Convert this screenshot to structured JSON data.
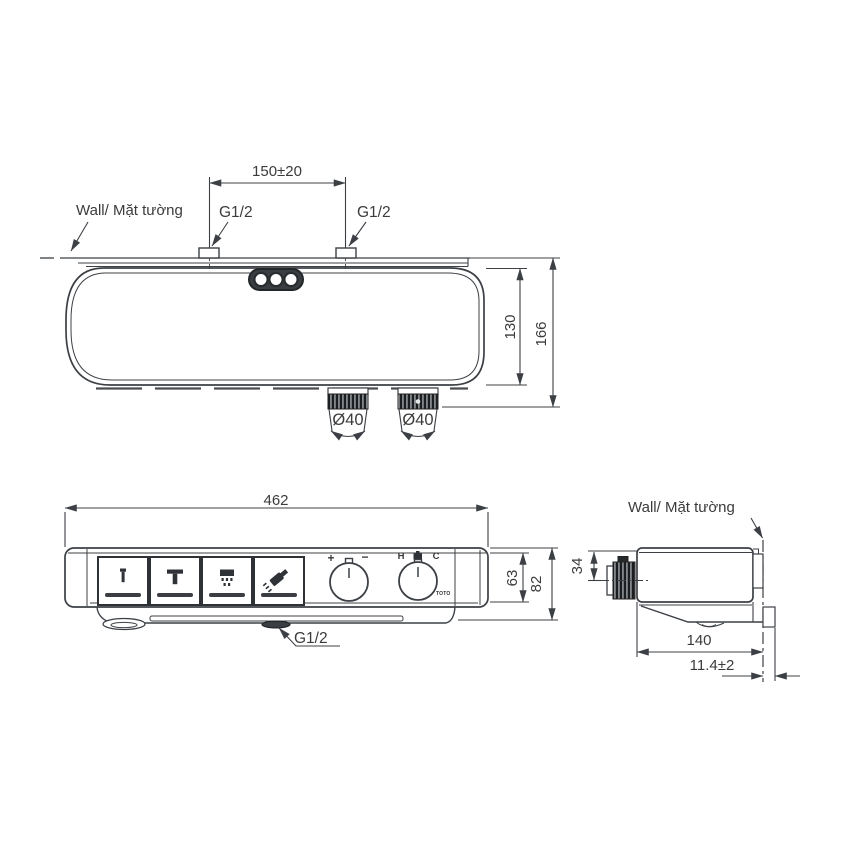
{
  "colors": {
    "line": "#3c4045",
    "text": "#3b3b3b",
    "dark_fill": "#33373b",
    "background": "#ffffff"
  },
  "top_view": {
    "wall_label": "Wall/ Mặt tường",
    "inlet_spacing_dim": "150±20",
    "left_inlet_thread": "G1/2",
    "right_inlet_thread": "G1/2",
    "left_knob_diameter": "Ø40",
    "right_knob_diameter": "Ø40",
    "body_depth_dim": "130",
    "overall_depth_dim": "166"
  },
  "front_view": {
    "width_dim": "462",
    "panel_height_dim": "63",
    "overall_height_dim": "82",
    "outlet_thread": "G1/2",
    "flow_knob": {
      "increase_label": "+",
      "decrease_label": "−"
    },
    "temperature_knob": {
      "hot_label": "H",
      "cold_label": "C"
    },
    "brand": "TOTO"
  },
  "side_view": {
    "wall_label": "Wall/ Mặt tường",
    "knob_depth_dim": "34",
    "body_depth_dim": "140",
    "wall_clearance_dim": "11.4±2"
  },
  "icons": {
    "button_1": "water-spout-icon",
    "button_2": "overhead-shower-icon",
    "button_3": "rain-shower-icon",
    "button_4": "hand-shower-icon",
    "temperature_knob_center": "mixer-icon",
    "top_outlets": "triple-outlet-icon"
  }
}
